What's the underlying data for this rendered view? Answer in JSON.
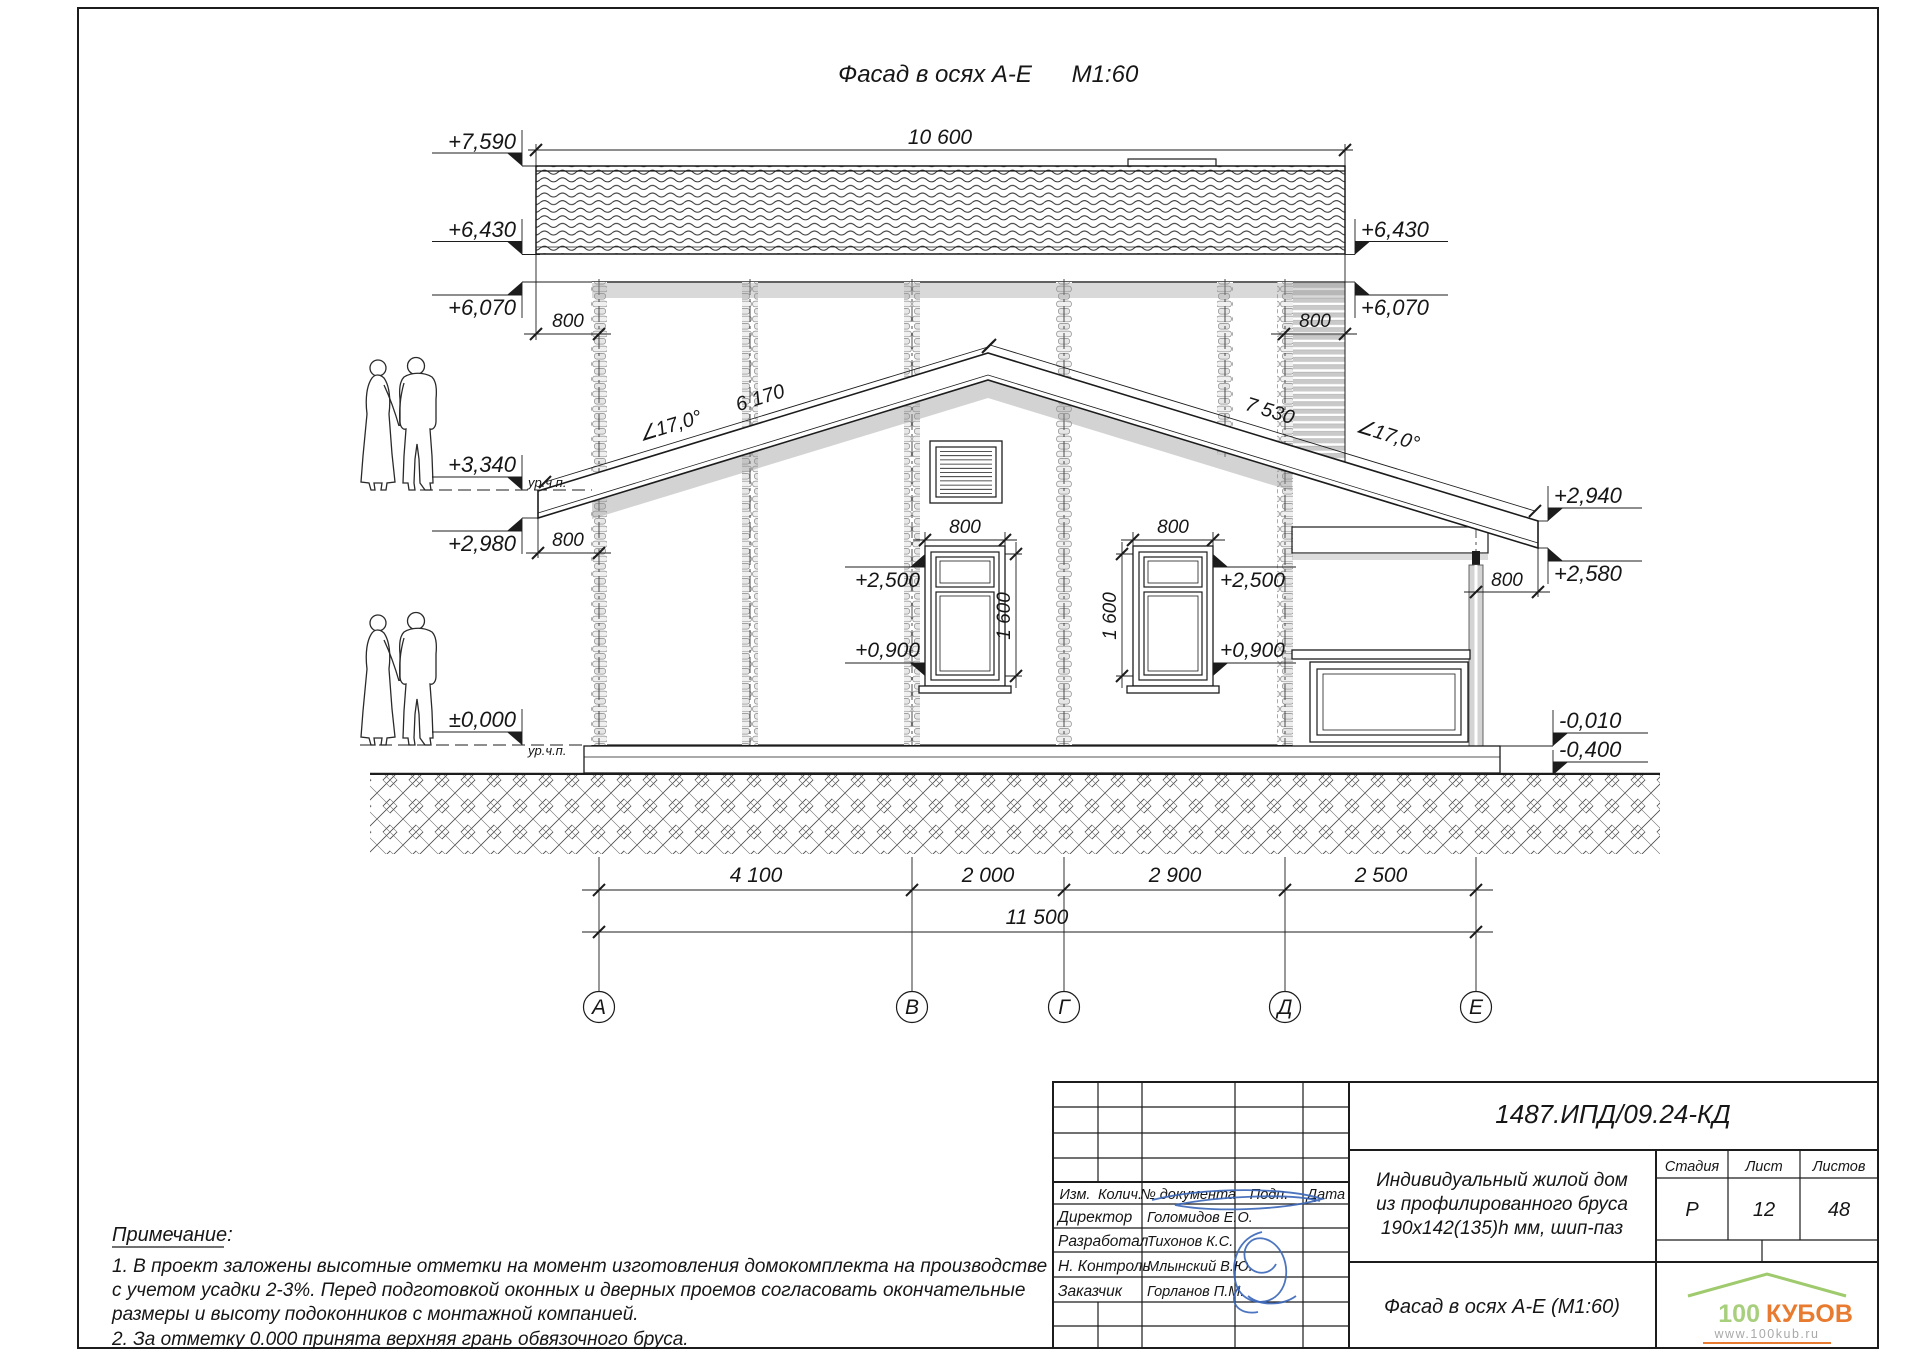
{
  "sheet": {
    "title": "Фасад в осях А-Е",
    "scale": "М1:60"
  },
  "elevation_marks": {
    "left": {
      "ridge": "+7,590",
      "eaves": "+6,430",
      "wall_top": "+6,070",
      "floor2": "+3,340",
      "canopy": "+2,980",
      "zero": "±0,000"
    },
    "right": {
      "eaves": "+6,430",
      "wall_top": "+6,070",
      "canopy_top": "+2,940",
      "canopy_bottom": "+2,580",
      "terrace_floor": "-0,010",
      "ground": "-0,400"
    },
    "floor_level_label": "ур.ч.п."
  },
  "dimensions": {
    "roof_length": "10 600",
    "overhang": "800",
    "roof_angle": "∠17,0°",
    "slope_left": "6 170",
    "slope_right": "7 530",
    "window_width": "800",
    "window_height": "1 600",
    "window_head": "+2,500",
    "window_sill": "+0,900",
    "span_ab": "4 100",
    "span_bg": "2 000",
    "span_gd": "2 900",
    "span_de": "2 500",
    "span_total": "11 500"
  },
  "axes": {
    "a": "А",
    "b": "В",
    "g": "Г",
    "d": "Д",
    "e": "Е"
  },
  "notes": {
    "header": "Примечание:",
    "line1": "1. В проект заложены высотные отметки на момент изготовления домокомплекта на производстве",
    "line2": "с учетом усадки 2-3%. Перед подготовкой оконных и дверных проемов согласовать окончательные",
    "line3": "размеры и высоту подоконников с монтажной компанией.",
    "line4": "2. За отметку 0.000 принята верхняя грань обвязочного бруса."
  },
  "titleblock": {
    "doc_number": "1487.ИПД/09.24-КД",
    "col_izm": "Изм.",
    "col_kolich": "Колич.",
    "col_doc": "№ документа",
    "col_podp": "Подп.",
    "col_data": "Дата",
    "row1_role": "Директор",
    "row1_name": "Голомидов Е.О.",
    "row2_role": "Разработал",
    "row2_name": "Тихонов К.С.",
    "row3_role": "Н. Контроль",
    "row3_name": "Млынский В.Ю.",
    "row4_role": "Заказчик",
    "row4_name": "Горланов П.М.",
    "project_line1": "Индивидуальный жилой дом",
    "project_line2": "из профилированного бруса",
    "project_line3": "190х142(135)h мм, шип-паз",
    "stage_label": "Стадия",
    "sheet_label": "Лист",
    "sheets_label": "Листов",
    "stage_value": "Р",
    "sheet_value": "12",
    "sheets_value": "48",
    "sheet_title": "Фасад в осях А-Е (М1:60)"
  },
  "logo": {
    "part1": "100",
    "part2": "КУБОВ",
    "url": "www.100kub.ru"
  },
  "colors": {
    "line": "#1c1c1c",
    "timber": "#c9c9c9",
    "logo_green": "#9fca6d",
    "logo_orange": "#e87b30",
    "signature_blue": "#3a66b8"
  }
}
